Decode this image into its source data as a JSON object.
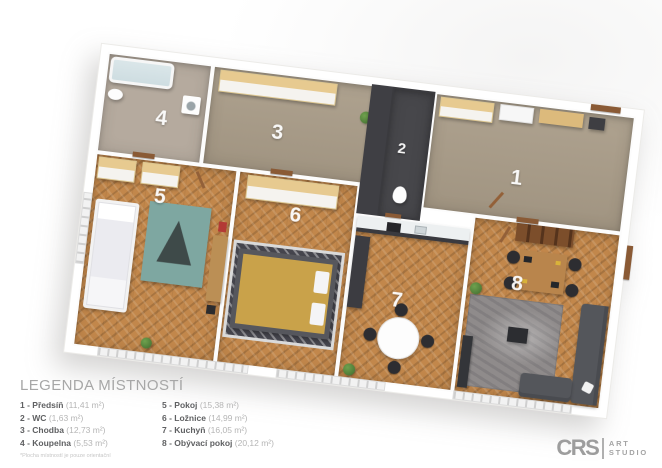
{
  "plan": {
    "rooms": [
      {
        "number": "1",
        "name": "Předsíň"
      },
      {
        "number": "2",
        "name": "WC"
      },
      {
        "number": "3",
        "name": "Chodba"
      },
      {
        "number": "4",
        "name": "Koupelna"
      },
      {
        "number": "5",
        "name": "Pokoj"
      },
      {
        "number": "6",
        "name": "Ložnice"
      },
      {
        "number": "7",
        "name": "Kuchyň"
      },
      {
        "number": "8",
        "name": "Obývací pokoj"
      }
    ],
    "colors": {
      "wood_floor": "#c2874b",
      "hall_floor": "#a99c88",
      "bath_floor": "#b5aa9e",
      "wall_white": "#ffffff",
      "dark_grey_units": "#3f3f44",
      "wood_cabinet_top": "#e7ca90",
      "door_wood": "#8a5a35",
      "rug_teal": "#7ea7a1",
      "bed_blanket_yellow": "#c9a24a"
    }
  },
  "legend": {
    "title": "LEGENDA MÍSTNOSTÍ",
    "items": [
      {
        "label": "1 - Předsíň",
        "area": "(11,41 m²)"
      },
      {
        "label": "2 - WC",
        "area": "(1,63 m²)"
      },
      {
        "label": "3 - Chodba",
        "area": "(12,73 m²)"
      },
      {
        "label": "4 - Koupelna",
        "area": "(5,53 m²)"
      },
      {
        "label": "5 - Pokoj",
        "area": "(15,38 m²)"
      },
      {
        "label": "6 - Ložnice",
        "area": "(14,99 m²)"
      },
      {
        "label": "7 - Kuchyň",
        "area": "(16,05 m²)"
      },
      {
        "label": "8 - Obývací pokoj",
        "area": "(20,12 m²)"
      }
    ],
    "footnote": "*Plocha místností je pouze orientační"
  },
  "logo": {
    "initials": "CRS",
    "line1": "ART",
    "line2": "STUDIO"
  }
}
